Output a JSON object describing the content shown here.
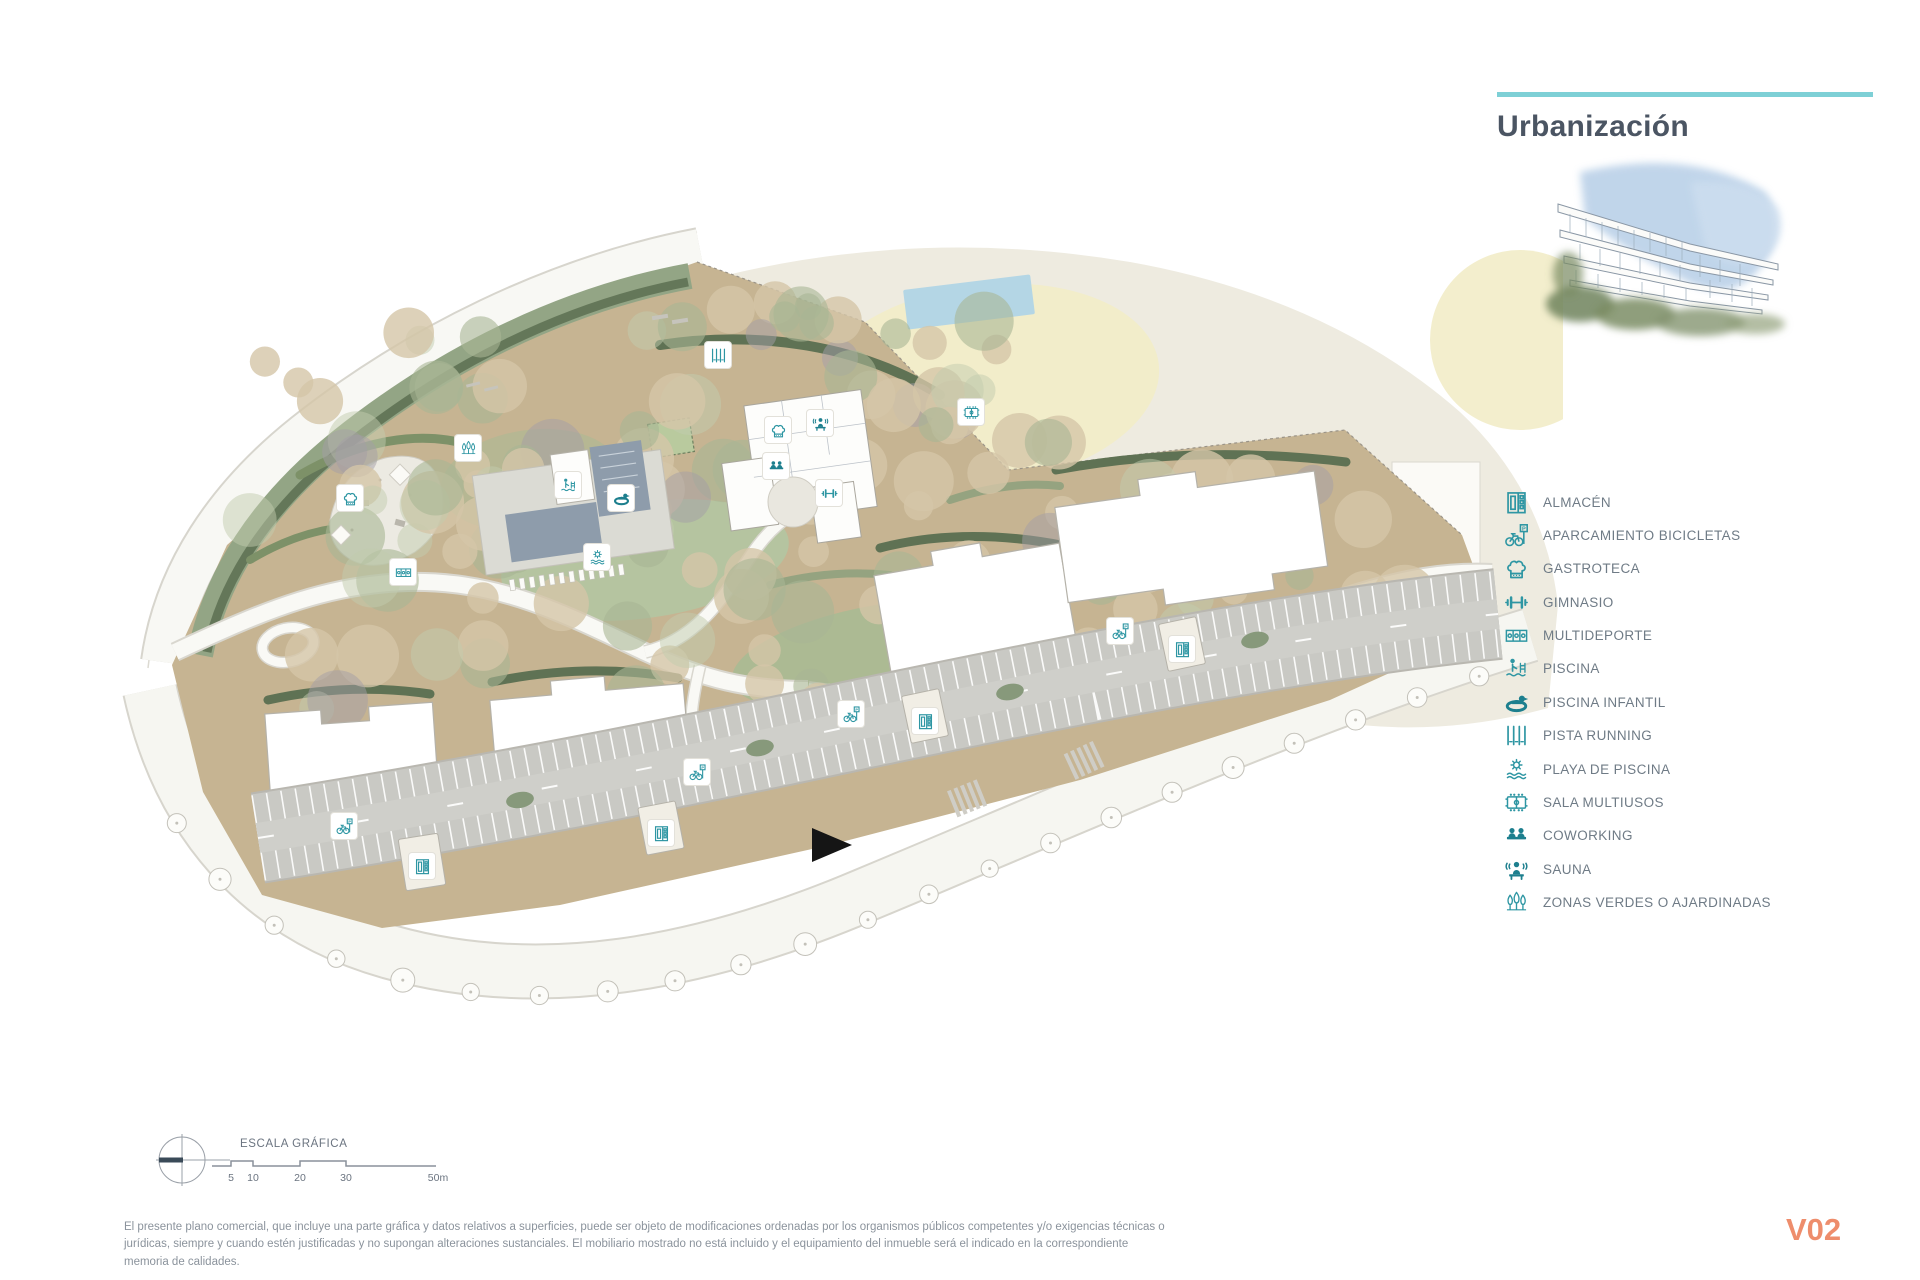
{
  "header": {
    "title": "Urbanización"
  },
  "legend": {
    "items": [
      {
        "icon": "almacen",
        "label": "ALMACÉN"
      },
      {
        "icon": "bike-parking",
        "label": "APARCAMIENTO BICICLETAS"
      },
      {
        "icon": "gastroteca",
        "label": "GASTROTECA"
      },
      {
        "icon": "gimnasio",
        "label": "GIMNASIO"
      },
      {
        "icon": "multideporte",
        "label": "MULTIDEPORTE"
      },
      {
        "icon": "piscina",
        "label": "PISCINA"
      },
      {
        "icon": "piscina-infantil",
        "label": "PISCINA INFANTIL"
      },
      {
        "icon": "pista-running",
        "label": "PISTA RUNNING"
      },
      {
        "icon": "playa-piscina",
        "label": "PLAYA DE PISCINA"
      },
      {
        "icon": "sala-multiusos",
        "label": "SALA MULTIUSOS"
      },
      {
        "icon": "coworking",
        "label": "COWORKING"
      },
      {
        "icon": "sauna",
        "label": "SAUNA"
      },
      {
        "icon": "zonas-verdes",
        "label": "ZONAS VERDES O AJARDINADAS"
      }
    ]
  },
  "map_icons": [
    {
      "type": "pista-running",
      "x": 718,
      "y": 355
    },
    {
      "type": "zonas-verdes",
      "x": 468,
      "y": 448
    },
    {
      "type": "gastroteca",
      "x": 350,
      "y": 498
    },
    {
      "type": "multideporte",
      "x": 403,
      "y": 572
    },
    {
      "type": "piscina",
      "x": 568,
      "y": 485
    },
    {
      "type": "piscina-infantil",
      "x": 621,
      "y": 498
    },
    {
      "type": "playa-piscina",
      "x": 597,
      "y": 557
    },
    {
      "type": "gastroteca",
      "x": 778,
      "y": 430
    },
    {
      "type": "sauna",
      "x": 820,
      "y": 423
    },
    {
      "type": "coworking",
      "x": 776,
      "y": 466
    },
    {
      "type": "gimnasio",
      "x": 829,
      "y": 493
    },
    {
      "type": "sala-multiusos",
      "x": 971,
      "y": 412
    },
    {
      "type": "almacen",
      "x": 422,
      "y": 866
    },
    {
      "type": "almacen",
      "x": 661,
      "y": 833
    },
    {
      "type": "almacen",
      "x": 925,
      "y": 721
    },
    {
      "type": "almacen",
      "x": 1182,
      "y": 649
    },
    {
      "type": "bike-parking",
      "x": 344,
      "y": 826
    },
    {
      "type": "bike-parking",
      "x": 697,
      "y": 772
    },
    {
      "type": "bike-parking",
      "x": 851,
      "y": 714
    },
    {
      "type": "bike-parking",
      "x": 1120,
      "y": 631
    }
  ],
  "scale": {
    "label": "ESCALA GRÁFICA",
    "ticks": [
      "5",
      "10",
      "20",
      "30",
      "50m"
    ]
  },
  "footer": {
    "disclaimer": "El presente plano comercial, que incluye una parte gráfica y datos relativos a superficies, puede ser objeto de modificaciones ordenadas por los organismos públicos competentes y/o exigencias técnicas o jurídicas, siempre y cuando estén justificadas y no supongan alteraciones sustanciales. El mobiliario mostrado no está incluido y el equipamiento del inmueble será el indicado en la correspondiente memoria de calidades.",
    "version": "V02"
  },
  "colors": {
    "accent_teal": "#7ed0d6",
    "icon_teal": "#2e96a3",
    "title_color": "#4b5563",
    "version_color": "#ee8d6c",
    "parcel_tan": "#c6b492",
    "green_dark": "#5f7254",
    "pool_blue": "#8e9cab"
  }
}
